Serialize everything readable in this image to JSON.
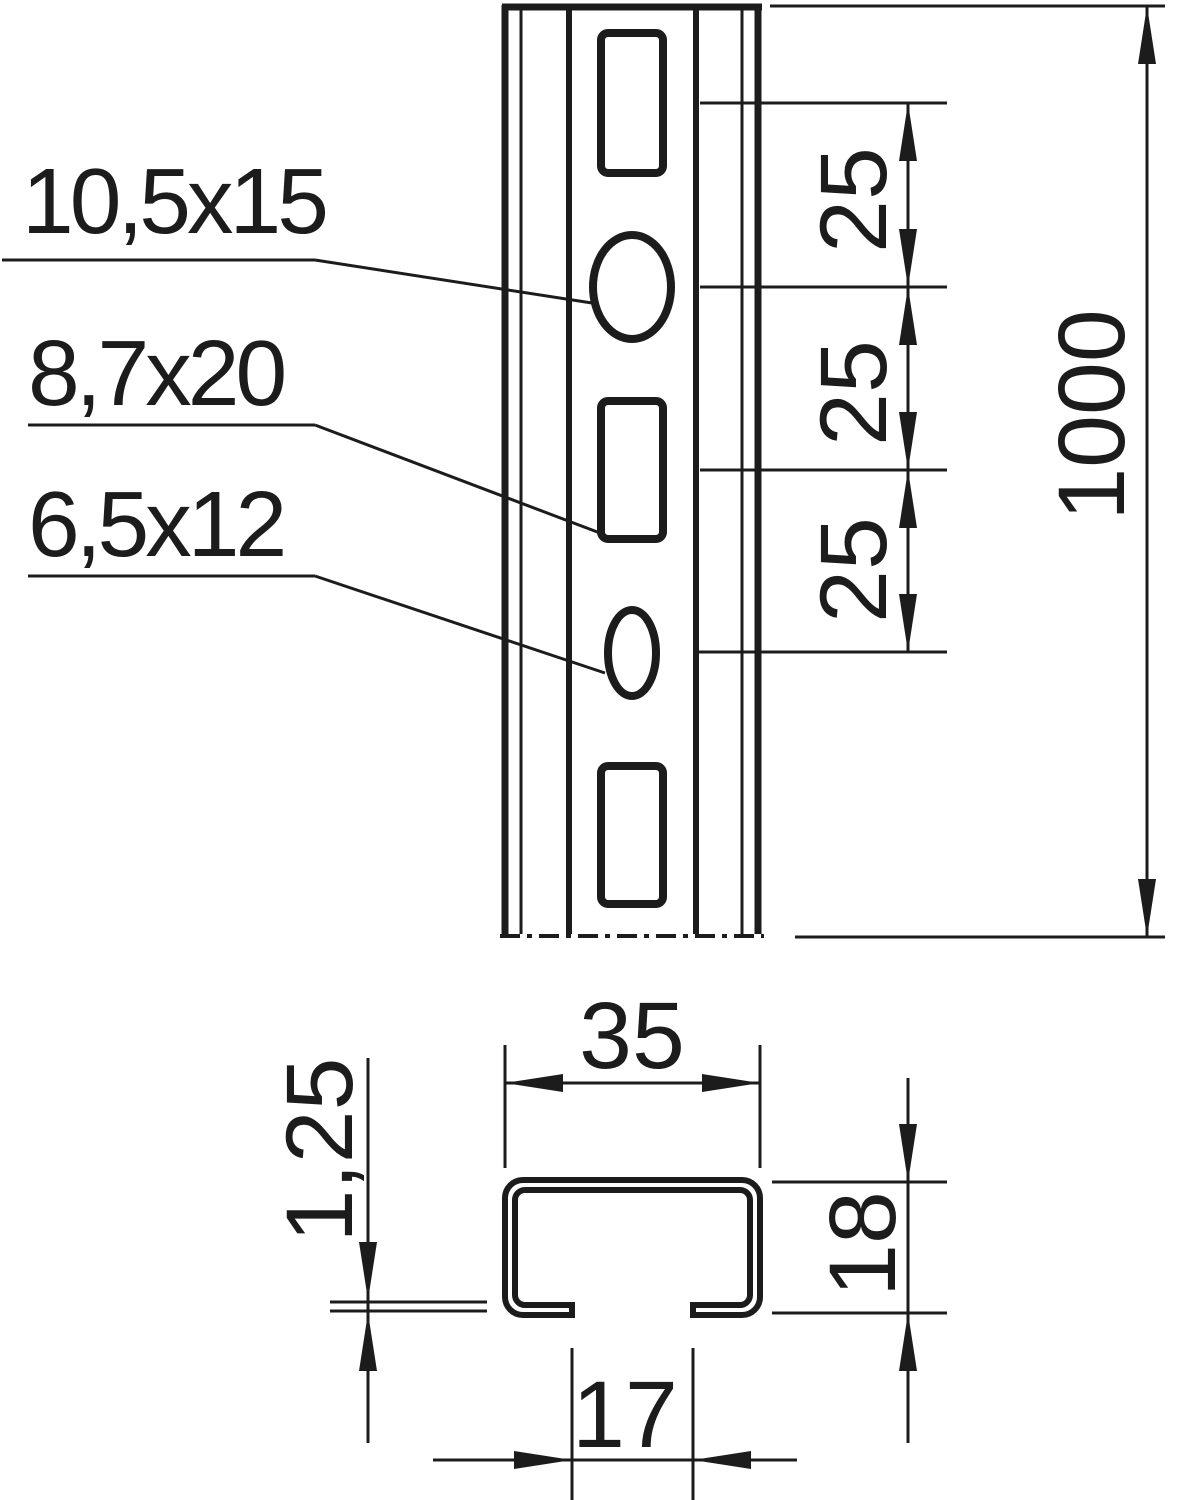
{
  "front_view": {
    "hole_labels": [
      "10,5x15",
      "8,7x20",
      "6,5x12"
    ],
    "pitch_dimensions": [
      "25",
      "25",
      "25"
    ],
    "length_dimension": "1000"
  },
  "section_view": {
    "width_dimension": "35",
    "material_thickness_dimension": "1,25",
    "height_dimension": "18",
    "opening_dimension": "17"
  },
  "colors": {
    "line": "#1c1c1c",
    "background": "#ffffff"
  }
}
